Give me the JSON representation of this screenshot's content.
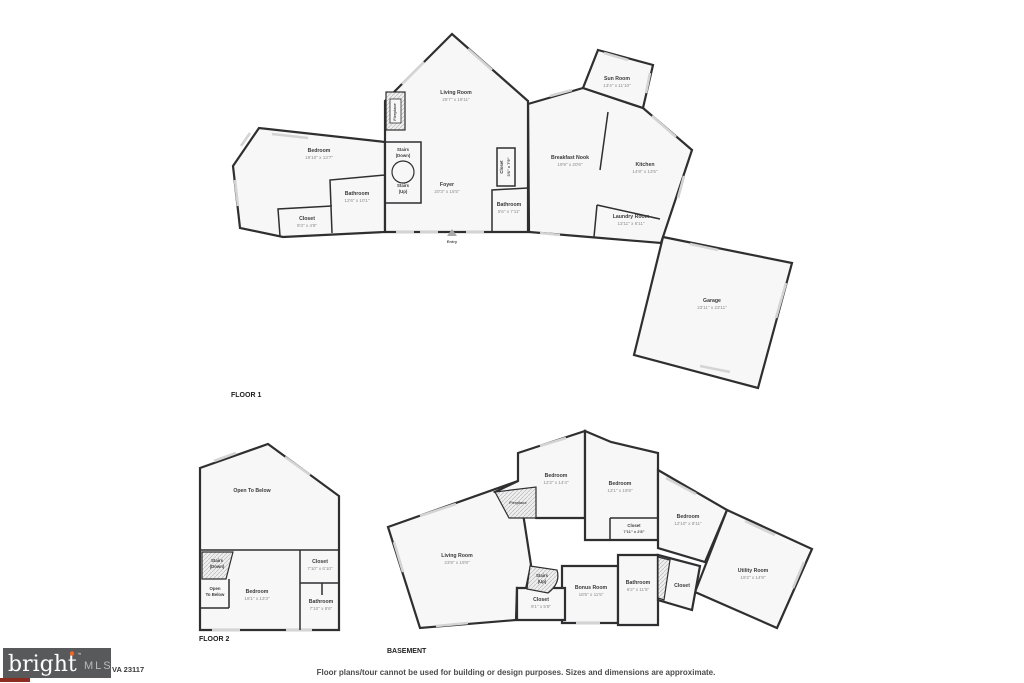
{
  "floor1": {
    "title": "FLOOR 1",
    "rooms": {
      "living_room": {
        "name": "Living Room",
        "dims": "25'7\" x 19'11\""
      },
      "sun_room": {
        "name": "Sun Room",
        "dims": "13'4\" x 11'10\""
      },
      "bedroom": {
        "name": "Bedroom",
        "dims": "19'10\" x 13'7\""
      },
      "bathroom_left": {
        "name": "Bathroom",
        "dims": "12'6\" x 10'1\""
      },
      "closet_left": {
        "name": "Closet",
        "dims": "9'3\" x 4'8\""
      },
      "stairs_down": {
        "name": "Stairs",
        "sub": "(Down)"
      },
      "stairs_up": {
        "name": "Stairs",
        "sub": "(Up)"
      },
      "foyer": {
        "name": "Foyer",
        "dims": "20'3\" x 15'5\""
      },
      "closet_mid": {
        "name": "Closet",
        "dims": "3'6\" x 7'9\""
      },
      "bathroom_mid": {
        "name": "Bathroom",
        "dims": "5'6\" x 7'11\""
      },
      "breakfast_nook": {
        "name": "Breakfast Nook",
        "dims": "19'9\" x 20'6\""
      },
      "kitchen": {
        "name": "Kitchen",
        "dims": "14'8\" x 13'5\""
      },
      "laundry_room": {
        "name": "Laundry Room",
        "dims": "13'11\" x 6'11\""
      },
      "garage": {
        "name": "Garage",
        "dims": "23'11\" x 23'11\""
      },
      "fireplace": {
        "name": "Fireplace"
      },
      "entry": {
        "name": "Entry"
      }
    }
  },
  "floor2": {
    "title": "FLOOR 2",
    "rooms": {
      "open_to_below_large": {
        "name": "Open To Below"
      },
      "stairs_down": {
        "name": "Stairs",
        "sub": "(Down)"
      },
      "open_to_below_small": {
        "name": "Open",
        "sub": "To Below"
      },
      "bedroom": {
        "name": "Bedroom",
        "dims": "18'1\" x 13'3\""
      },
      "closet": {
        "name": "Closet",
        "dims": "7'10\" x 6'10\""
      },
      "bathroom": {
        "name": "Bathroom",
        "dims": "7'10\" x 8'6\""
      }
    }
  },
  "basement": {
    "title": "BASEMENT",
    "rooms": {
      "bedroom_left": {
        "name": "Bedroom",
        "dims": "12'2\" x 14'4\""
      },
      "fireplace": {
        "name": "Fireplace"
      },
      "bedroom_mid": {
        "name": "Bedroom",
        "dims": "13'1\" x 19'8\""
      },
      "closet_mid": {
        "name": "Closet",
        "dims": "7'11\" x 2'8\""
      },
      "bedroom_right": {
        "name": "Bedroom",
        "dims": "12'10\" x 8'11\""
      },
      "living_room": {
        "name": "Living Room",
        "dims": "23'8\" x 19'8\""
      },
      "stairs_up": {
        "name": "Stairs",
        "sub": "(Up)"
      },
      "closet_small": {
        "name": "Closet",
        "dims": "9'1\" x 5'8\""
      },
      "bonus_room": {
        "name": "Bonus Room",
        "dims": "18'5\" x 11'5\""
      },
      "bathroom": {
        "name": "Bathroom",
        "dims": "6'2\" x 11'5\""
      },
      "closet_right": {
        "name": "Closet"
      },
      "utility_room": {
        "name": "Utility Room",
        "dims": "19'2\" x 14'9\""
      }
    }
  },
  "footer": {
    "logo_bright": "bright",
    "logo_tm": "™",
    "logo_mls": "MLS",
    "address": "VA 23117",
    "disclaimer": "Floor plans/tour cannot be used for building or design purposes. Sizes and dimensions are approximate."
  }
}
